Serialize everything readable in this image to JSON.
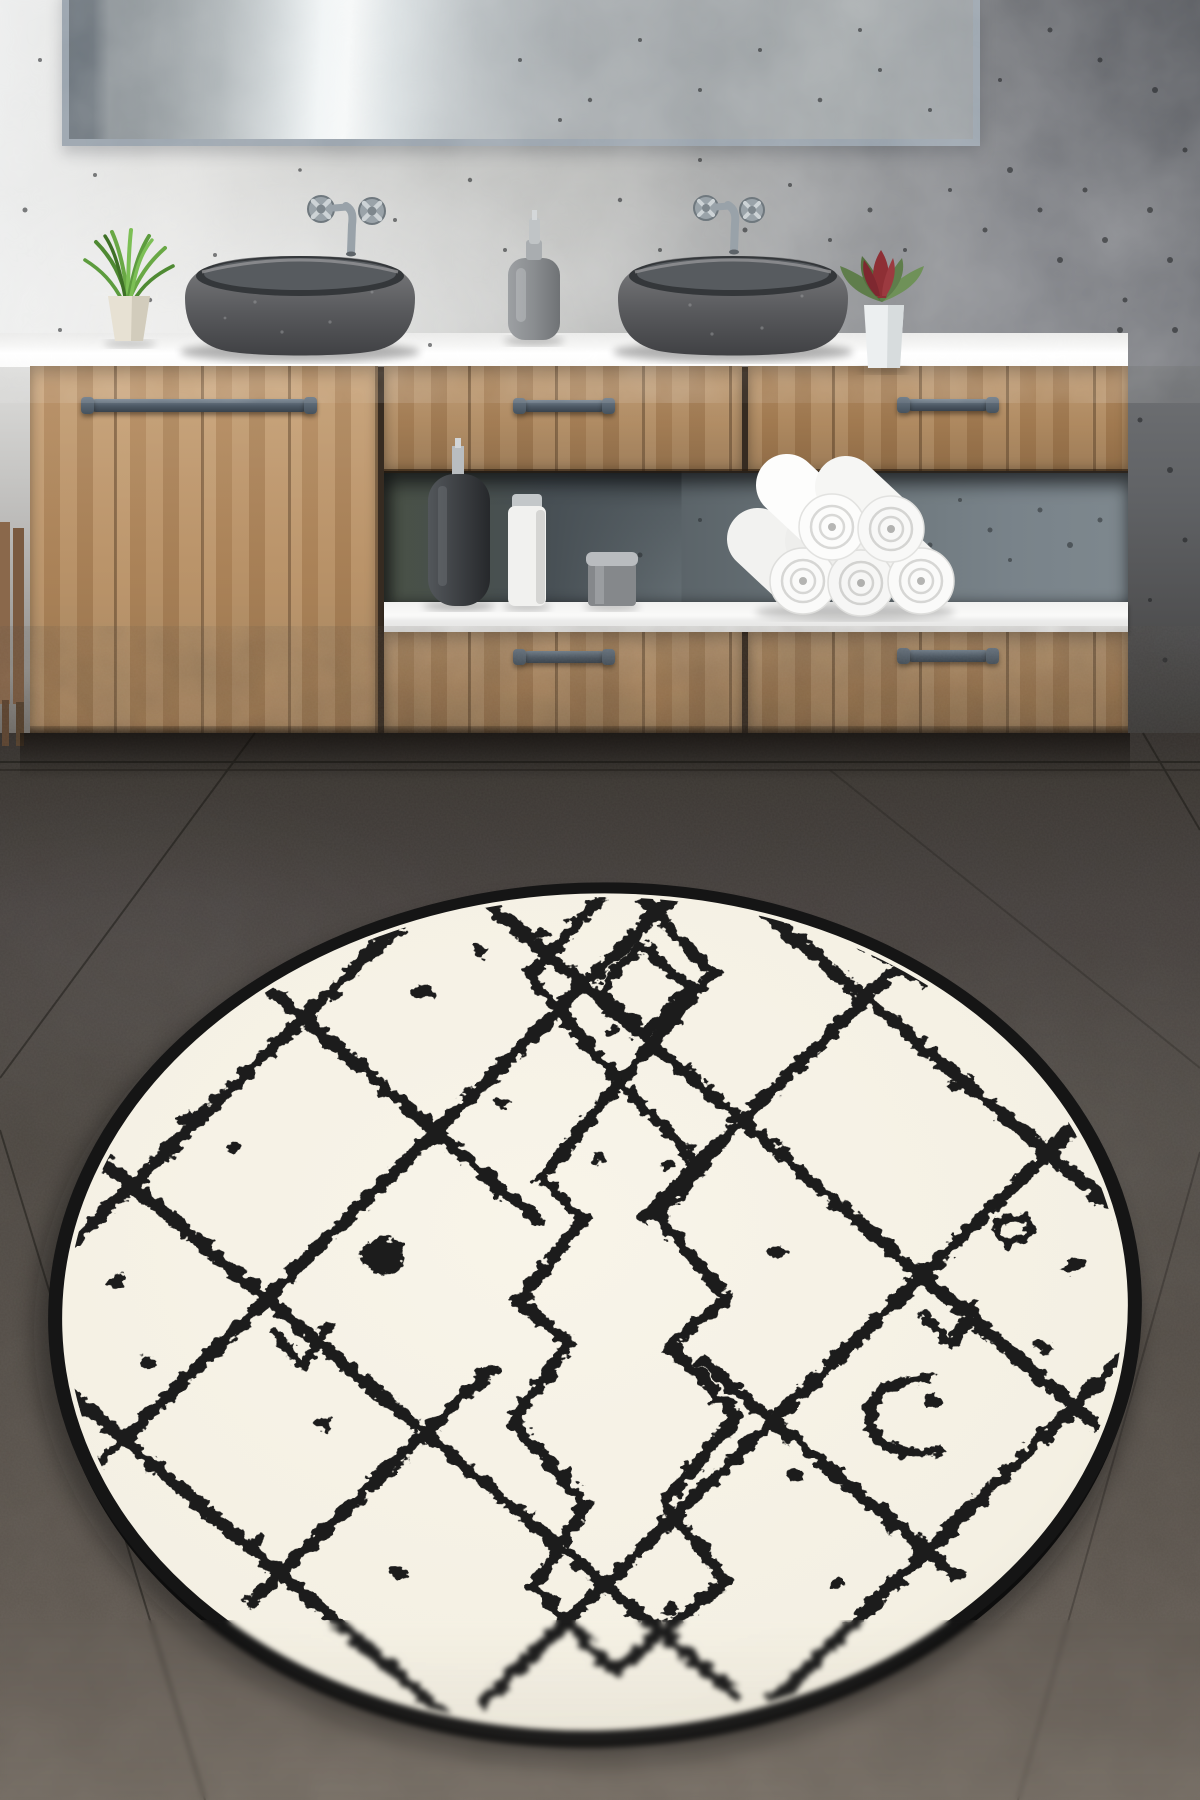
{
  "image_type": "product-photo",
  "title": "Round cream Berber-pattern rug in a modern bathroom",
  "scene": {
    "wall": {
      "label": "speckled concrete wall",
      "light_color": "#e6e6e4",
      "dark_color": "#707276"
    },
    "mirror": {
      "label": "wide wall mirror with gray frame",
      "frame_color": "#97a1ab"
    },
    "vanity": {
      "label": "floating oak bathroom vanity with white countertop",
      "countertop_color": "#fafafa",
      "wood_color": "#b28a5f",
      "handle_color": "#4d5965",
      "handle_count": 5,
      "sections": [
        "left door with towel-bar handle",
        "upper middle drawer",
        "upper right drawer",
        "open shelf niche",
        "lower middle drawer",
        "lower right drawer"
      ]
    },
    "sinks": {
      "label": "two oval gray stone vessel sinks",
      "count": 2,
      "color": "#55585c"
    },
    "faucets": {
      "label": "wall-mounted chrome faucets with cross handles",
      "count": 2,
      "color": "#9aa3a9"
    },
    "decor": {
      "green_plant": {
        "label": "green grass plant in cream pot",
        "pot_color": "#e7e1d3",
        "leaf_color": "#69a845"
      },
      "red_plant": {
        "label": "red bromeliad plant in white pot",
        "pot_color": "#eceff0",
        "leaf_color": "#5f7d4b",
        "flower_color": "#8e2f35"
      },
      "soap_dispenser": {
        "label": "gray soap dispenser with chrome pump",
        "color": "#8a8d90"
      },
      "towels": {
        "label": "pyramid stack of rolled white towels",
        "count": 5,
        "color": "#f6f6f5"
      },
      "shelf_items": [
        "dark matte soap bottle",
        "white cylindrical bottle",
        "silver jar"
      ]
    },
    "chair": {
      "label": "wooden chair edge at far left",
      "color": "#81614a"
    },
    "floor": {
      "label": "dark gray stone tile floor",
      "color": "#4a4540",
      "seam_color": "#1d1b19"
    },
    "rug": {
      "label": "round cream rug with hand-drawn black Berber diamond lattice",
      "shape": "round",
      "field_color": "#f5f1e4",
      "pattern_color": "#1c1c1c",
      "border_color": "#151515",
      "motifs": [
        "diamond lattice",
        "central stepped diamond chain",
        "small top diamond",
        "scattered dots",
        "check marks",
        "C bracket",
        "solid blob and ring dot"
      ]
    }
  }
}
